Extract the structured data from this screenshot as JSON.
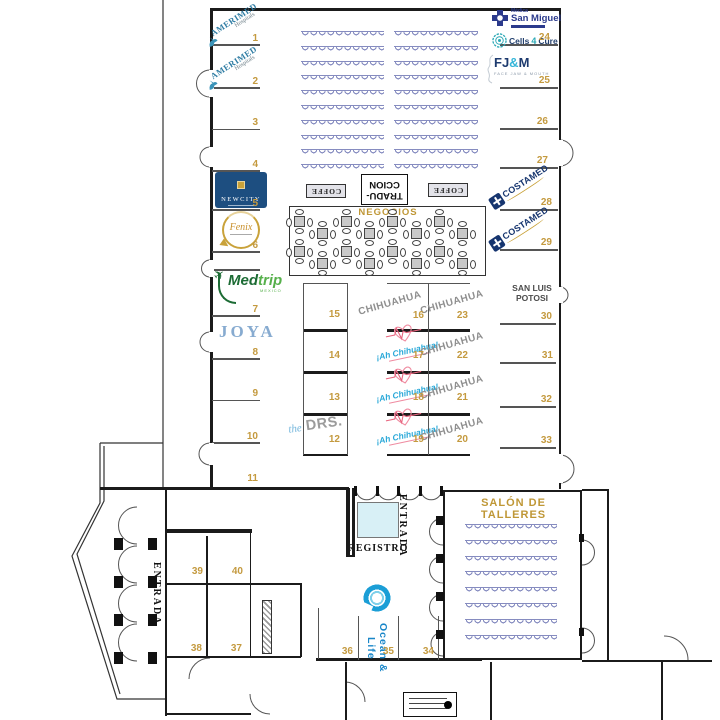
{
  "colors": {
    "booth_number": "#c49a3f",
    "gold_label": "#bf9736",
    "wall": "#1b1b1b",
    "seat_outline": "#868cc0",
    "registro_fill": "#d8f0f6",
    "chihuahua_gray": "#8f8f8f",
    "ah_chihuahua_blue": "#29a8d8",
    "ah_chihuahua_pink": "#e8657f",
    "amerimed_teal": "#2e7ca3",
    "san_miguel_navy": "#2b3a8c",
    "costamed_navy": "#16356f",
    "fjm_navy": "#1d3a6e",
    "fjm_cyan": "#37b6d9",
    "cells_teal": "#2aa8b5",
    "medtrip_green": "#1c6b34",
    "medtrip_light_green": "#56b04b",
    "joya_blue": "#87abd0",
    "drs_gray": "#9b9b9b",
    "drs_script_blue": "#74b6dc",
    "ocean_blue": "#1986c8",
    "newcity_blue": "#1d4e80",
    "fenix_gold": "#c9a23a"
  },
  "labels": {
    "negocios": "NEGOCIOS",
    "coffee": "COFFE",
    "traduccion_line1": "TRADU-",
    "traduccion_line2": "CCION",
    "registro": "REGISTRO",
    "entrada": "ENTRADA",
    "salon_talleres": "SALÓN DE TALLERES",
    "san_luis_1": "SAN LUIS",
    "san_luis_2": "POTOSI",
    "chihuahua": "CHIHUAHUA"
  },
  "icons": {
    "plane": "✈"
  },
  "logos": {
    "amerimed": {
      "name": "AMERIMED",
      "sub": "Hospitals"
    },
    "san_miguel": {
      "pre": "Médica",
      "name": "San Miguel"
    },
    "cells4cure": {
      "part1": "Cells",
      "part2": "4",
      "part3": "Cure"
    },
    "fjm": {
      "fj": "FJ",
      "amp": "&",
      "m": "M",
      "sub": "FACE JAW & MOUTH"
    },
    "costamed": {
      "name": "COSTAMED"
    },
    "newcity": {
      "name": "NEWCITY"
    },
    "fenix": {
      "name": "Fenix"
    },
    "medtrip": {
      "med": "Med",
      "trip": "trip",
      "sub": "MEXICO"
    },
    "joya": {
      "name": "JOYA"
    },
    "thedrs": {
      "the": "the",
      "drs": "DRS."
    },
    "ah_chihuahua": {
      "name": "¡Ah Chihuahua!"
    },
    "ocean_life": {
      "name": "Ocean & Life"
    }
  },
  "booths": [
    {
      "n": "1",
      "exhibitor": "AMERIMED Hospitals"
    },
    {
      "n": "2",
      "exhibitor": "AMERIMED Hospitals"
    },
    {
      "n": "3",
      "exhibitor": ""
    },
    {
      "n": "4",
      "exhibitor": ""
    },
    {
      "n": "5",
      "exhibitor": "NEWCITY"
    },
    {
      "n": "6",
      "exhibitor": "Fenix"
    },
    {
      "n": "7",
      "exhibitor": "Medtrip"
    },
    {
      "n": "8",
      "exhibitor": "JOYA"
    },
    {
      "n": "9",
      "exhibitor": ""
    },
    {
      "n": "10",
      "exhibitor": ""
    },
    {
      "n": "11",
      "exhibitor": ""
    },
    {
      "n": "12",
      "exhibitor": "the DRS."
    },
    {
      "n": "13",
      "exhibitor": ""
    },
    {
      "n": "14",
      "exhibitor": ""
    },
    {
      "n": "15",
      "exhibitor": ""
    },
    {
      "n": "16",
      "exhibitor": "CHIHUAHUA"
    },
    {
      "n": "17",
      "exhibitor": "¡Ah Chihuahua!"
    },
    {
      "n": "18",
      "exhibitor": "¡Ah Chihuahua!"
    },
    {
      "n": "19",
      "exhibitor": "¡Ah Chihuahua!"
    },
    {
      "n": "20",
      "exhibitor": "CHIHUAHUA"
    },
    {
      "n": "21",
      "exhibitor": "CHIHUAHUA"
    },
    {
      "n": "22",
      "exhibitor": "CHIHUAHUA"
    },
    {
      "n": "23",
      "exhibitor": "CHIHUAHUA"
    },
    {
      "n": "24",
      "exhibitor": "Médica San Miguel / Cells4Cure"
    },
    {
      "n": "25",
      "exhibitor": "FJ&M"
    },
    {
      "n": "26",
      "exhibitor": ""
    },
    {
      "n": "27",
      "exhibitor": ""
    },
    {
      "n": "28",
      "exhibitor": "COSTAMED"
    },
    {
      "n": "29",
      "exhibitor": "COSTAMED"
    },
    {
      "n": "30",
      "exhibitor": "SAN LUIS POTOSI"
    },
    {
      "n": "31",
      "exhibitor": ""
    },
    {
      "n": "32",
      "exhibitor": ""
    },
    {
      "n": "33",
      "exhibitor": ""
    },
    {
      "n": "34",
      "exhibitor": ""
    },
    {
      "n": "35",
      "exhibitor": "Ocean & Life"
    },
    {
      "n": "36",
      "exhibitor": ""
    },
    {
      "n": "37",
      "exhibitor": ""
    },
    {
      "n": "38",
      "exhibitor": ""
    },
    {
      "n": "39",
      "exhibitor": ""
    },
    {
      "n": "40",
      "exhibitor": ""
    }
  ]
}
